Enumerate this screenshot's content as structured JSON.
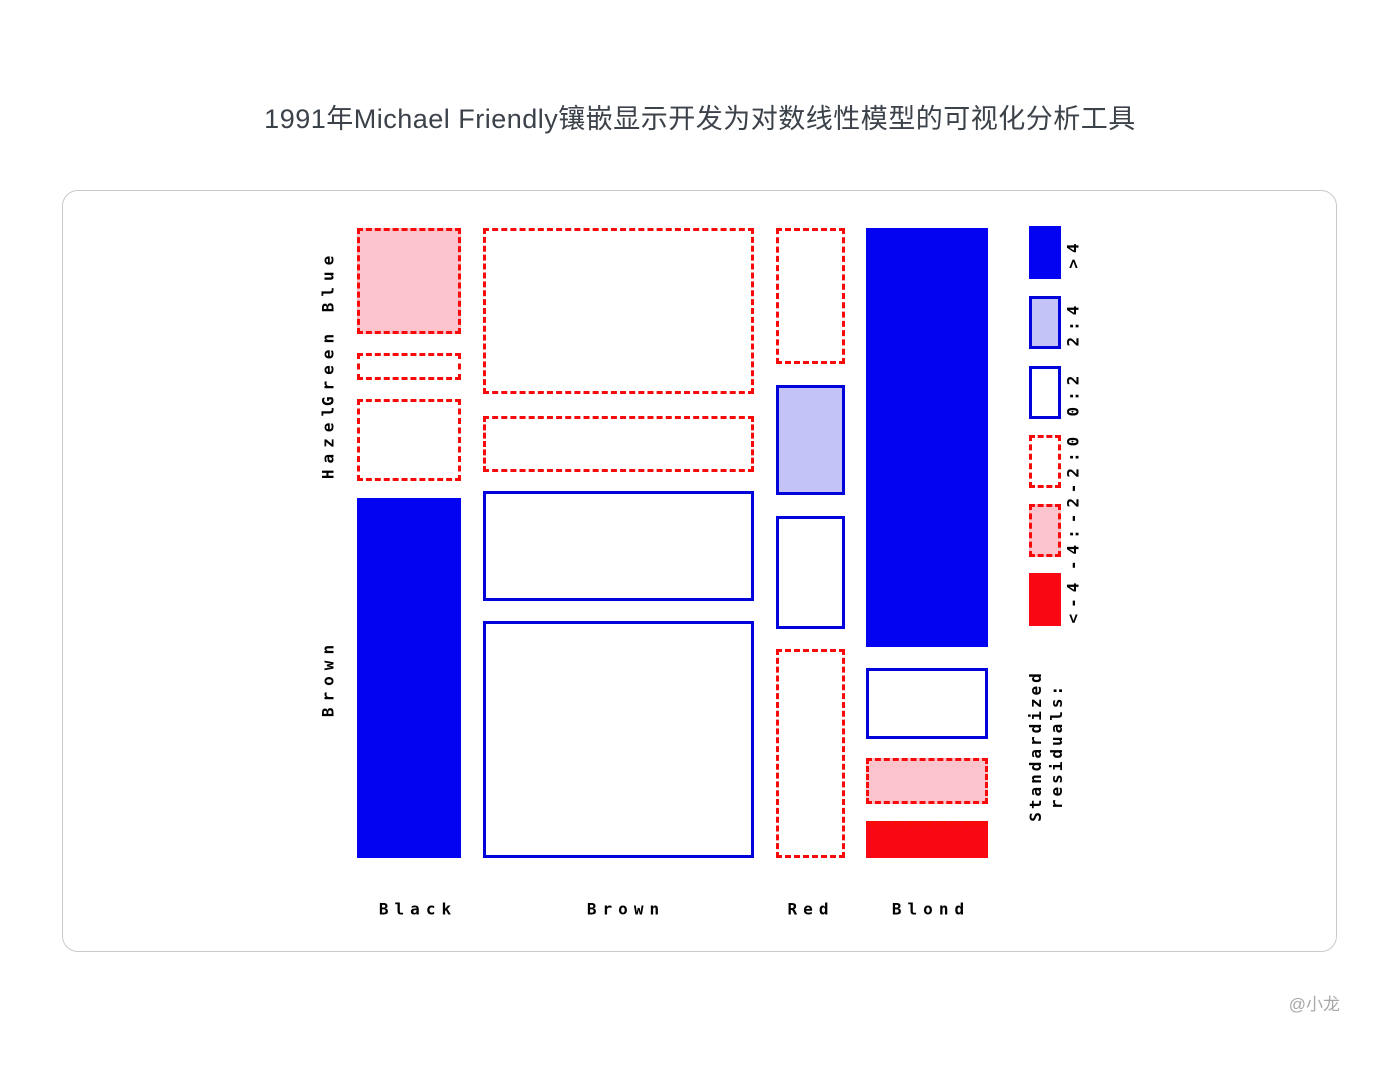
{
  "page": {
    "title": "1991年Michael Friendly镶嵌显示开发为对数线性模型的可视化分析工具",
    "watermark": "@小龙"
  },
  "chart_data": {
    "type": "mosaic",
    "title": "1991年Michael Friendly镶嵌显示开发为对数线性模型的可视化分析工具",
    "x_categories": [
      "Black",
      "Brown",
      "Red",
      "Blond"
    ],
    "y_categories": [
      "Blue",
      "Green",
      "Hazel",
      "Brown"
    ],
    "legend": {
      "position": "right",
      "title": "Standardized\nresiduals:",
      "items": [
        {
          "label": ">4",
          "level": ">4"
        },
        {
          "label": "2:4",
          "level": "2:4"
        },
        {
          "label": "0:2",
          "level": "0:2"
        },
        {
          "label": "-2:0",
          "level": "-2:0"
        },
        {
          "label": "-4:-2",
          "level": "-4:-2"
        },
        {
          "label": "<-4",
          "level": "<-4"
        }
      ]
    },
    "colors": {
      "solid_blue": "#0303f2",
      "blue_border": "#0202da",
      "lavender": "#c3c3f8",
      "pink": "#fbc3cb",
      "solid_red": "#f90713",
      "red_border": "#f90a0a",
      "white": "#ffffff"
    },
    "level_styles": {
      ">4": {
        "fill": "#0303f2",
        "border": "none"
      },
      "2:4": {
        "fill": "#c3c3f8",
        "border": "3px solid #0202da"
      },
      "0:2": {
        "fill": "#ffffff",
        "border": "3px solid #0202da"
      },
      "-2:0": {
        "fill": "#ffffff",
        "border": "3px dashed #f90a0a"
      },
      "-4:-2": {
        "fill": "#fbc3cb",
        "border": "3px dashed #f90a0a"
      },
      "<-4": {
        "fill": "#f90713",
        "border": "5px dashed #f90a0a",
        "border_sides": "top"
      }
    },
    "tiles": [
      {
        "hair": "Black",
        "eye": "Blue",
        "level": "-4:-2",
        "x": 294,
        "y": 37,
        "w": 104,
        "h": 106
      },
      {
        "hair": "Black",
        "eye": "Green",
        "level": "-2:0",
        "x": 294,
        "y": 162,
        "w": 104,
        "h": 27
      },
      {
        "hair": "Black",
        "eye": "Hazel",
        "level": "-2:0",
        "x": 294,
        "y": 208,
        "w": 104,
        "h": 82
      },
      {
        "hair": "Black",
        "eye": "Brown",
        "level": ">4",
        "x": 294,
        "y": 307,
        "w": 104,
        "h": 360
      },
      {
        "hair": "Brown",
        "eye": "Blue",
        "level": "-2:0",
        "x": 420,
        "y": 37,
        "w": 271,
        "h": 166
      },
      {
        "hair": "Brown",
        "eye": "Green",
        "level": "-2:0",
        "x": 420,
        "y": 225,
        "w": 271,
        "h": 56
      },
      {
        "hair": "Brown",
        "eye": "Hazel",
        "level": "0:2",
        "x": 420,
        "y": 300,
        "w": 271,
        "h": 110
      },
      {
        "hair": "Brown",
        "eye": "Brown",
        "level": "0:2",
        "x": 420,
        "y": 430,
        "w": 271,
        "h": 237
      },
      {
        "hair": "Red",
        "eye": "Blue",
        "level": "-2:0",
        "x": 713,
        "y": 37,
        "w": 69,
        "h": 136
      },
      {
        "hair": "Red",
        "eye": "Green",
        "level": "2:4",
        "x": 713,
        "y": 194,
        "w": 69,
        "h": 110
      },
      {
        "hair": "Red",
        "eye": "Hazel",
        "level": "0:2",
        "x": 713,
        "y": 325,
        "w": 69,
        "h": 113
      },
      {
        "hair": "Red",
        "eye": "Brown",
        "level": "-2:0",
        "x": 713,
        "y": 458,
        "w": 69,
        "h": 209
      },
      {
        "hair": "Blond",
        "eye": "Blue",
        "level": ">4",
        "x": 803,
        "y": 37,
        "w": 122,
        "h": 419
      },
      {
        "hair": "Blond",
        "eye": "Green",
        "level": "0:2",
        "x": 803,
        "y": 477,
        "w": 122,
        "h": 71
      },
      {
        "hair": "Blond",
        "eye": "Hazel",
        "level": "-4:-2",
        "x": 803,
        "y": 567,
        "w": 122,
        "h": 46
      },
      {
        "hair": "Blond",
        "eye": "Brown",
        "level": "<-4",
        "x": 803,
        "y": 630,
        "w": 122,
        "h": 37
      }
    ],
    "layout": {
      "grid": false,
      "x_label_cy": 718,
      "x_label_centers": [
        355,
        563,
        748,
        868
      ],
      "y_label_cx": 265,
      "y_label_centers": [
        90,
        176,
        249,
        487
      ],
      "legend_x": 966,
      "legend_swatch_w": 32,
      "legend_swatch_h": 53,
      "legend_swatch_ys": [
        35,
        105,
        175,
        244,
        313,
        382
      ],
      "legend_label_cx": 1010,
      "legend_title_cx": 983,
      "legend_title_cy": 555
    }
  }
}
